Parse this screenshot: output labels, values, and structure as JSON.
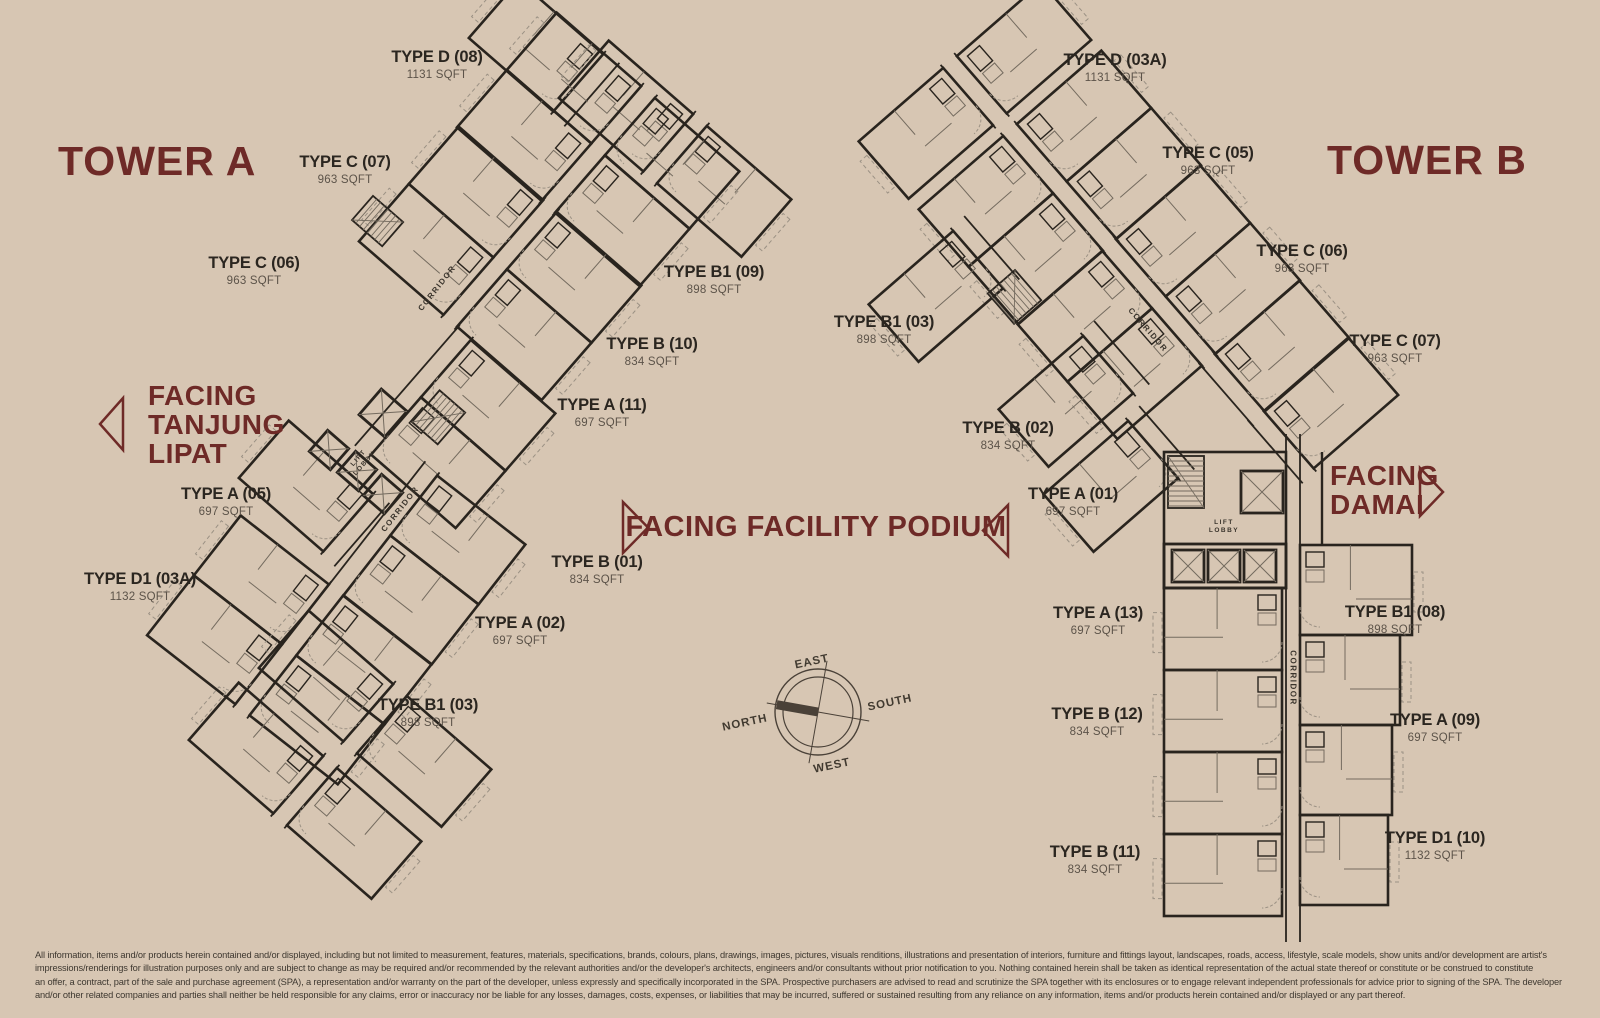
{
  "towers": {
    "a": {
      "title": "TOWER A",
      "units": [
        {
          "label": "TYPE D (08)",
          "sqft": "1131 SQFT"
        },
        {
          "label": "TYPE C (07)",
          "sqft": "963 SQFT"
        },
        {
          "label": "TYPE C (06)",
          "sqft": "963 SQFT"
        },
        {
          "label": "TYPE B1 (09)",
          "sqft": "898 SQFT"
        },
        {
          "label": "TYPE B (10)",
          "sqft": "834 SQFT"
        },
        {
          "label": "TYPE A (11)",
          "sqft": "697 SQFT"
        },
        {
          "label": "TYPE A (05)",
          "sqft": "697 SQFT"
        },
        {
          "label": "TYPE D1 (03A)",
          "sqft": "1132 SQFT"
        },
        {
          "label": "TYPE B (01)",
          "sqft": "834 SQFT"
        },
        {
          "label": "TYPE A (02)",
          "sqft": "697 SQFT"
        },
        {
          "label": "TYPE B1 (03)",
          "sqft": "898 SQFT"
        }
      ]
    },
    "b": {
      "title": "TOWER B",
      "units": [
        {
          "label": "TYPE D (03A)",
          "sqft": "1131 SQFT"
        },
        {
          "label": "TYPE C (05)",
          "sqft": "963 SQFT"
        },
        {
          "label": "TYPE C (06)",
          "sqft": "963 SQFT"
        },
        {
          "label": "TYPE B1 (03)",
          "sqft": "898 SQFT"
        },
        {
          "label": "TYPE C (07)",
          "sqft": "963 SQFT"
        },
        {
          "label": "TYPE B (02)",
          "sqft": "834 SQFT"
        },
        {
          "label": "TYPE A (01)",
          "sqft": "697 SQFT"
        },
        {
          "label": "TYPE A (13)",
          "sqft": "697 SQFT"
        },
        {
          "label": "TYPE B1 (08)",
          "sqft": "898 SQFT"
        },
        {
          "label": "TYPE B (12)",
          "sqft": "834 SQFT"
        },
        {
          "label": "TYPE A (09)",
          "sqft": "697 SQFT"
        },
        {
          "label": "TYPE B (11)",
          "sqft": "834 SQFT"
        },
        {
          "label": "TYPE D1 (10)",
          "sqft": "1132 SQFT"
        }
      ]
    }
  },
  "facing": {
    "tanjung_lipat": {
      "lines": [
        "FACING",
        "TANJUNG",
        "LIPAT"
      ]
    },
    "facility_podium": {
      "label": "FACING FACILITY PODIUM"
    },
    "damai": {
      "lines": [
        "FACING",
        "DAMAI"
      ]
    }
  },
  "plan_labels": {
    "corridor": "CORRIDOR",
    "lift": "LIFT",
    "lobby": "LOBBY"
  },
  "compass": {
    "north": "NORTH",
    "south": "SOUTH",
    "east": "EAST",
    "west": "WEST"
  },
  "disclaimer": {
    "lines": [
      "All information, items and/or products herein contained and/or displayed, including but not limited to measurement, features, materials, specifications, brands, colours, plans, drawings, images, pictures, visuals renditions, illustrations and presentation of interiors, furniture and fittings layout, landscapes, roads, access, lifestyle, scale models, show units and/or development are artist's",
      "impressions/renderings for illustration purposes only and are subject to change as may be required and/or recommended by the relevant authorities and/or the developer's architects, engineers and/or consultants without prior notification to you. Nothing contained herein shall be taken as identical representation of the actual state thereof or constitute or be construed to constitute",
      "an offer, a contract, part of the sale and purchase agreement (SPA), a representation and/or warranty on the part of the developer, unless expressly and specifically incorporated in the SPA. Prospective purchasers are advised to read and scrutinize the SPA together with its enclosures or to engage relevant independent professionals for advice prior to signing of the SPA. The developer",
      "and/or other related companies and parties shall neither be held responsible for any claims, error or inaccuracy nor be liable for any losses, damages, costs, expenses, or liabilities that may be incurred, suffered or sustained resulting from any reliance on any information, items and/or products herein contained and/or displayed or any part thereof."
    ]
  },
  "colors": {
    "background": "#d7c6b3",
    "accent": "#6e2a27",
    "wall": "#29241e"
  }
}
